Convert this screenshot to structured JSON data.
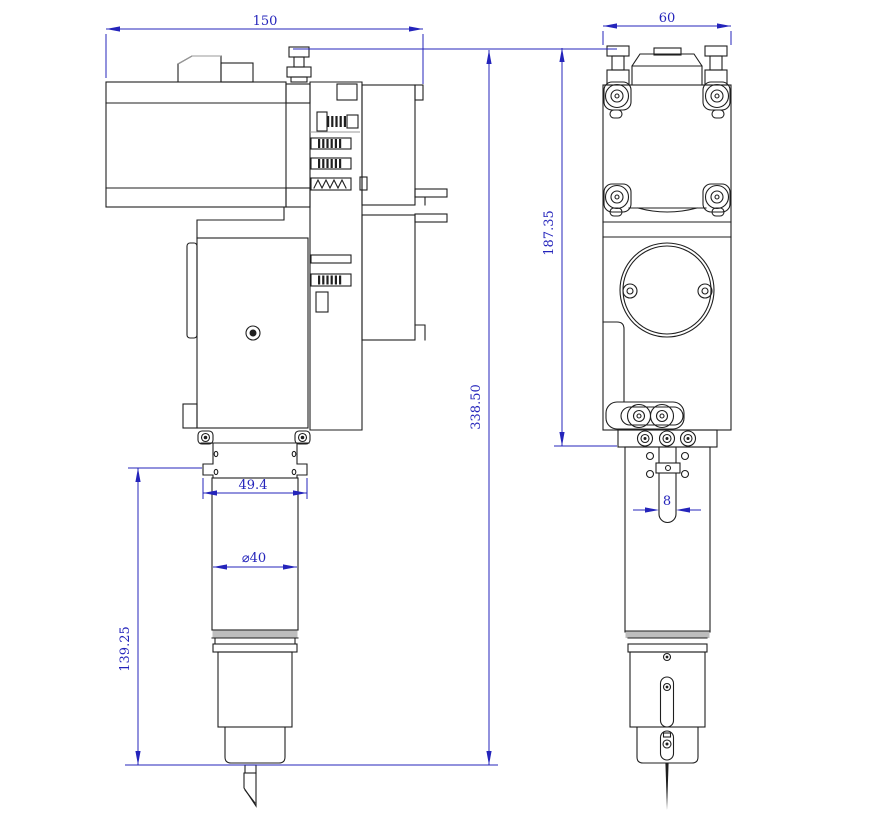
{
  "dimensions": {
    "overall_width": "150",
    "side_width": "60",
    "total_height": "338.50",
    "body_height": "187.35",
    "lower_section_height": "139.25",
    "mount_width": "49.4",
    "barrel_diameter": "⌀40",
    "slot_width": "8"
  },
  "colors": {
    "line": "#1f1f1f",
    "gray": "#9a9a9a",
    "band": "#bdbdbd",
    "dimension": "#2424bb",
    "background": "#ffffff"
  }
}
